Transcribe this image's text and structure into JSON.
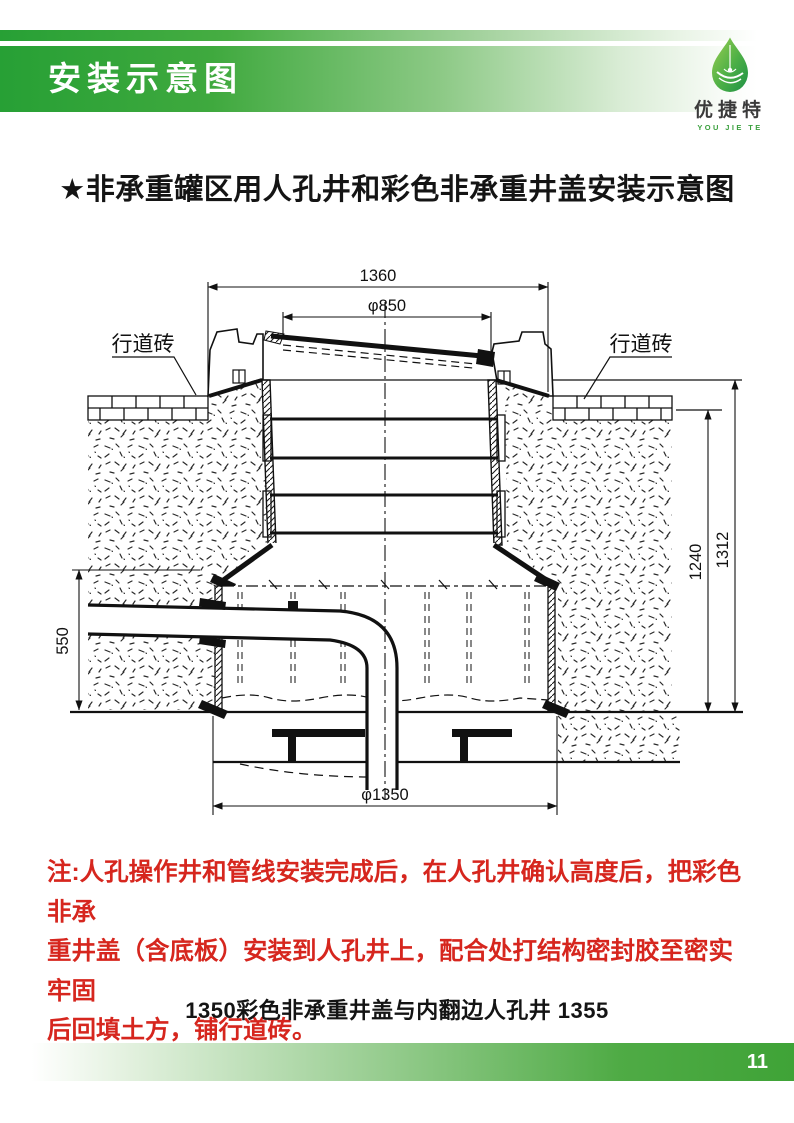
{
  "header": {
    "title": "安装示意图",
    "logo": {
      "icon": "water-drop-leaf-icon",
      "name": "优捷特",
      "sub": "YOU JIE TE"
    }
  },
  "section_title": "★非承重罐区用人孔井和彩色非承重井盖安装示意图",
  "diagram": {
    "labels": {
      "pavement_left": "行道砖",
      "pavement_right": "行道砖"
    },
    "dimensions": {
      "top_width": "1360",
      "cover_diameter": "φ850",
      "depth_inner": "1240",
      "depth_outer": "1312",
      "left_height": "550",
      "base_diameter": "φ1350"
    }
  },
  "note": {
    "lines": [
      "注:人孔操作井和管线安装完成后，在人孔井确认高度后，把彩色非承",
      "重井盖（含底板）安装到人孔井上，配合处打结构密封胶至密实牢固",
      "后回填土方，铺行道砖。"
    ]
  },
  "caption": "1350彩色非承重井盖与内翻边人孔井 1355",
  "footer": {
    "page": "11"
  },
  "colors": {
    "brand_green": "#2ea43c",
    "note_red": "#d6261e"
  }
}
